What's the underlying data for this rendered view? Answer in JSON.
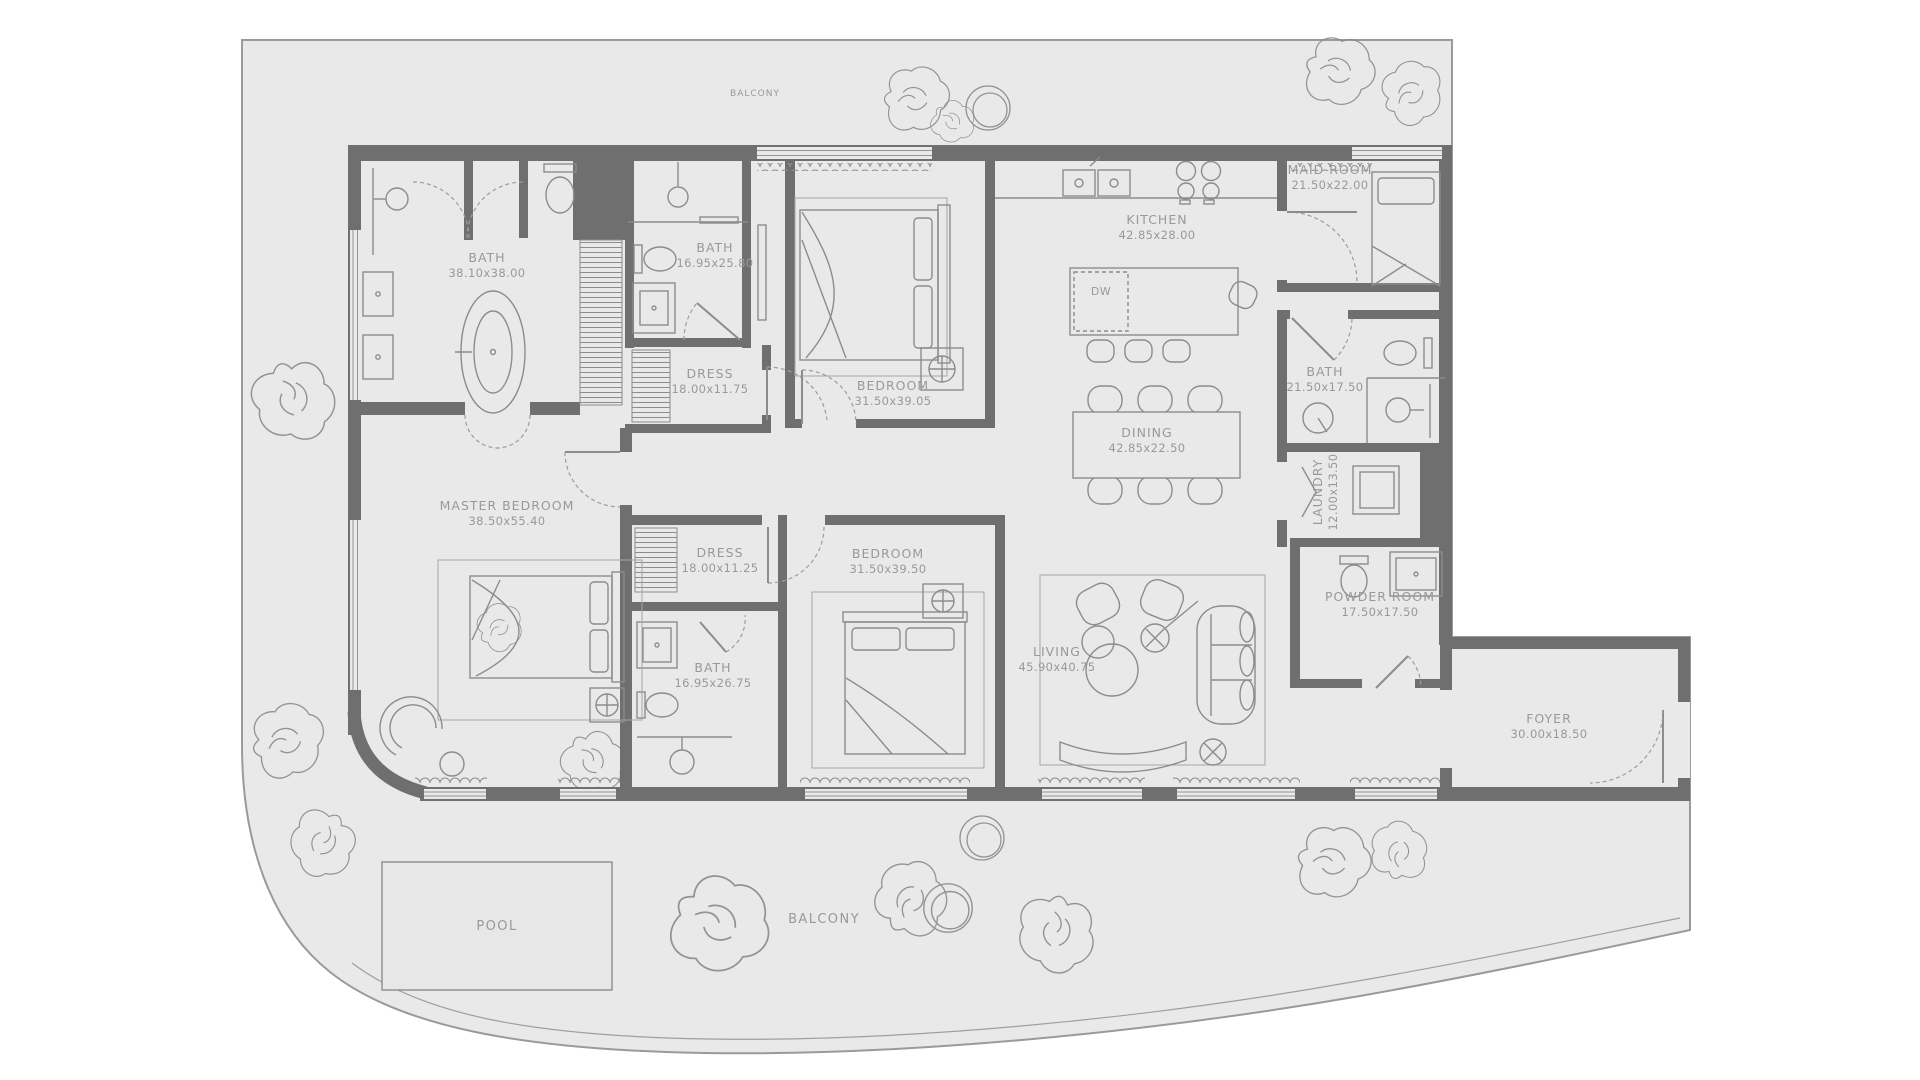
{
  "plan": {
    "colors": {
      "floor": "#e9e9e9",
      "wall": "#6f6f6f",
      "furniture": "#8c8c8c",
      "text": "#98999b",
      "outline": "#9a9a9a"
    },
    "rooms": [
      {
        "id": "master-bath",
        "name": "BATH",
        "dims": "38.10x38.00"
      },
      {
        "id": "bath-2",
        "name": "BATH",
        "dims": "16.95x25.80"
      },
      {
        "id": "dress-1",
        "name": "DRESS",
        "dims": "18.00x11.75"
      },
      {
        "id": "bedroom-1",
        "name": "BEDROOM",
        "dims": "31.50x39.05"
      },
      {
        "id": "kitchen",
        "name": "KITCHEN",
        "dims": "42.85x28.00"
      },
      {
        "id": "maid-room",
        "name": "MAID ROOM",
        "dims": "21.50x22.00"
      },
      {
        "id": "bath-3",
        "name": "BATH",
        "dims": "21.50x17.50"
      },
      {
        "id": "dining",
        "name": "DINING",
        "dims": "42.85x22.50"
      },
      {
        "id": "laundry",
        "name": "LAUNDRY",
        "dims": "12.00x13.50"
      },
      {
        "id": "master-bedroom",
        "name": "MASTER BEDROOM",
        "dims": "38.50x55.40"
      },
      {
        "id": "dress-2",
        "name": "DRESS",
        "dims": "18.00x11.25"
      },
      {
        "id": "bedroom-2",
        "name": "BEDROOM",
        "dims": "31.50x39.50"
      },
      {
        "id": "bath-4",
        "name": "BATH",
        "dims": "16.95x26.75"
      },
      {
        "id": "living",
        "name": "LIVING",
        "dims": "45.90x40.75"
      },
      {
        "id": "powder-room",
        "name": "POWDER ROOM",
        "dims": "17.50x17.50"
      },
      {
        "id": "foyer",
        "name": "FOYER",
        "dims": "30.00x18.50"
      }
    ],
    "areas": {
      "pool": "POOL",
      "balcony_lower": "BALCONY",
      "balcony_upper": "BALCONY"
    },
    "appliances": {
      "dishwasher": "DW"
    }
  }
}
